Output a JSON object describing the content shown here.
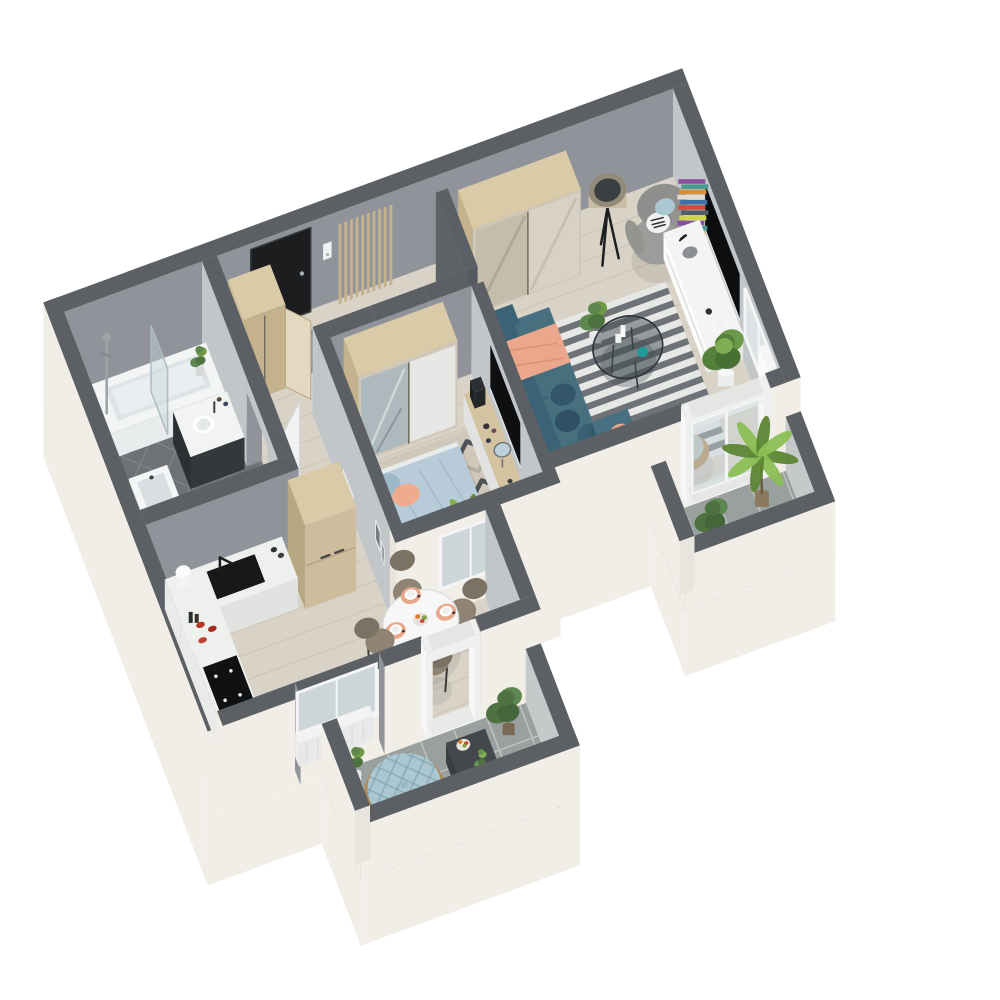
{
  "scene": {
    "title": "3D isometric floor plan render of a one-bedroom apartment",
    "type": "isometric-3d-floorplan",
    "doormat_text": "WELCOME"
  },
  "palette": {
    "bg": "#ffffff",
    "exterior": "#f1eee7",
    "wallCap": "#5c6065",
    "wallMid": "#90949a",
    "wallLight": "#c3c6c9",
    "wallDark": "#5f6368",
    "wallStub": "#56595e",
    "woodFloor": "#d9d3c7",
    "plankLine": "#cbc4b6",
    "bathFloor": "#6e7277",
    "bathLine": "#80858c",
    "tile": "#9aa09d",
    "tileLine": "#bfc5c1",
    "woodLight": "#d9cba8",
    "woodMid": "#c3b28c",
    "woodDark": "#a5936f",
    "white": "#f4f5f4",
    "offWhite": "#e6e8e6",
    "teal": "#40667a",
    "tealDark": "#34566a",
    "tealTop": "#477083",
    "peach": "#eba78b",
    "peachDark": "#dd9274",
    "blueLight": "#b7ccd8",
    "blueMid": "#9db8c8",
    "benchBlue": "#a9c4cd",
    "grayChair": "#9c9c9a",
    "rugLight": "#e7e7e5",
    "rugDark": "#6e7377",
    "bedRug": "#cfc8ba",
    "bedRugDark": "#4e5256",
    "black": "#121416",
    "doorDark": "#1b1d1f",
    "glass": "rgba(200,212,218,0.45)",
    "greenLight": "#8cbf55",
    "green": "#6f9a43",
    "greenDark": "#4e7240",
    "rattan": "#b08954",
    "cushion": "#abc8d2",
    "pot": "#7a6a55",
    "chrome": "#9aa2a6",
    "taupe": "#8f8474",
    "taupeDark": "#7c7263",
    "red": "#b83326",
    "mirror": "#aeb9bd"
  },
  "rooms": [
    {
      "name": "entrance-hall",
      "furniture": [
        "front-door",
        "welcome-doormat",
        "shoes",
        "intercom",
        "wood-slat-partition",
        "blue-bench",
        "wardrobe-closet"
      ]
    },
    {
      "name": "bathroom",
      "furniture": [
        "bathtub",
        "shower-column",
        "glass-screen",
        "washbasin",
        "dark-vanity-sink"
      ]
    },
    {
      "name": "kitchen-dining",
      "furniture": [
        "sink-counter",
        "tall-cabinet",
        "cooktop-counter",
        "round-dining-table",
        "dining-chairs",
        "window",
        "radiator",
        "balcony-door"
      ]
    },
    {
      "name": "bedroom",
      "furniture": [
        "mirrored-wardrobe",
        "double-bed",
        "nightstand",
        "geometric-rug",
        "dressing-table",
        "wall-tv",
        "pouf",
        "palm-plant",
        "window"
      ]
    },
    {
      "name": "living-room",
      "furniture": [
        "sliding-wardrobe",
        "floor-lamp",
        "armchair",
        "book-tower",
        "tv-stand",
        "wall-tv",
        "striped-rug",
        "coffee-table",
        "sofa",
        "plants",
        "basket-chair",
        "french-door",
        "curtain"
      ]
    },
    {
      "name": "balcony-right",
      "furniture": [
        "palm-plant",
        "monstera-plant",
        "potted-plant",
        "tiled-floor"
      ]
    },
    {
      "name": "balcony-bottom",
      "furniture": [
        "papasan-chair",
        "coffee-table",
        "fruit-bowl",
        "monstera-plant",
        "tiled-floor"
      ]
    }
  ]
}
